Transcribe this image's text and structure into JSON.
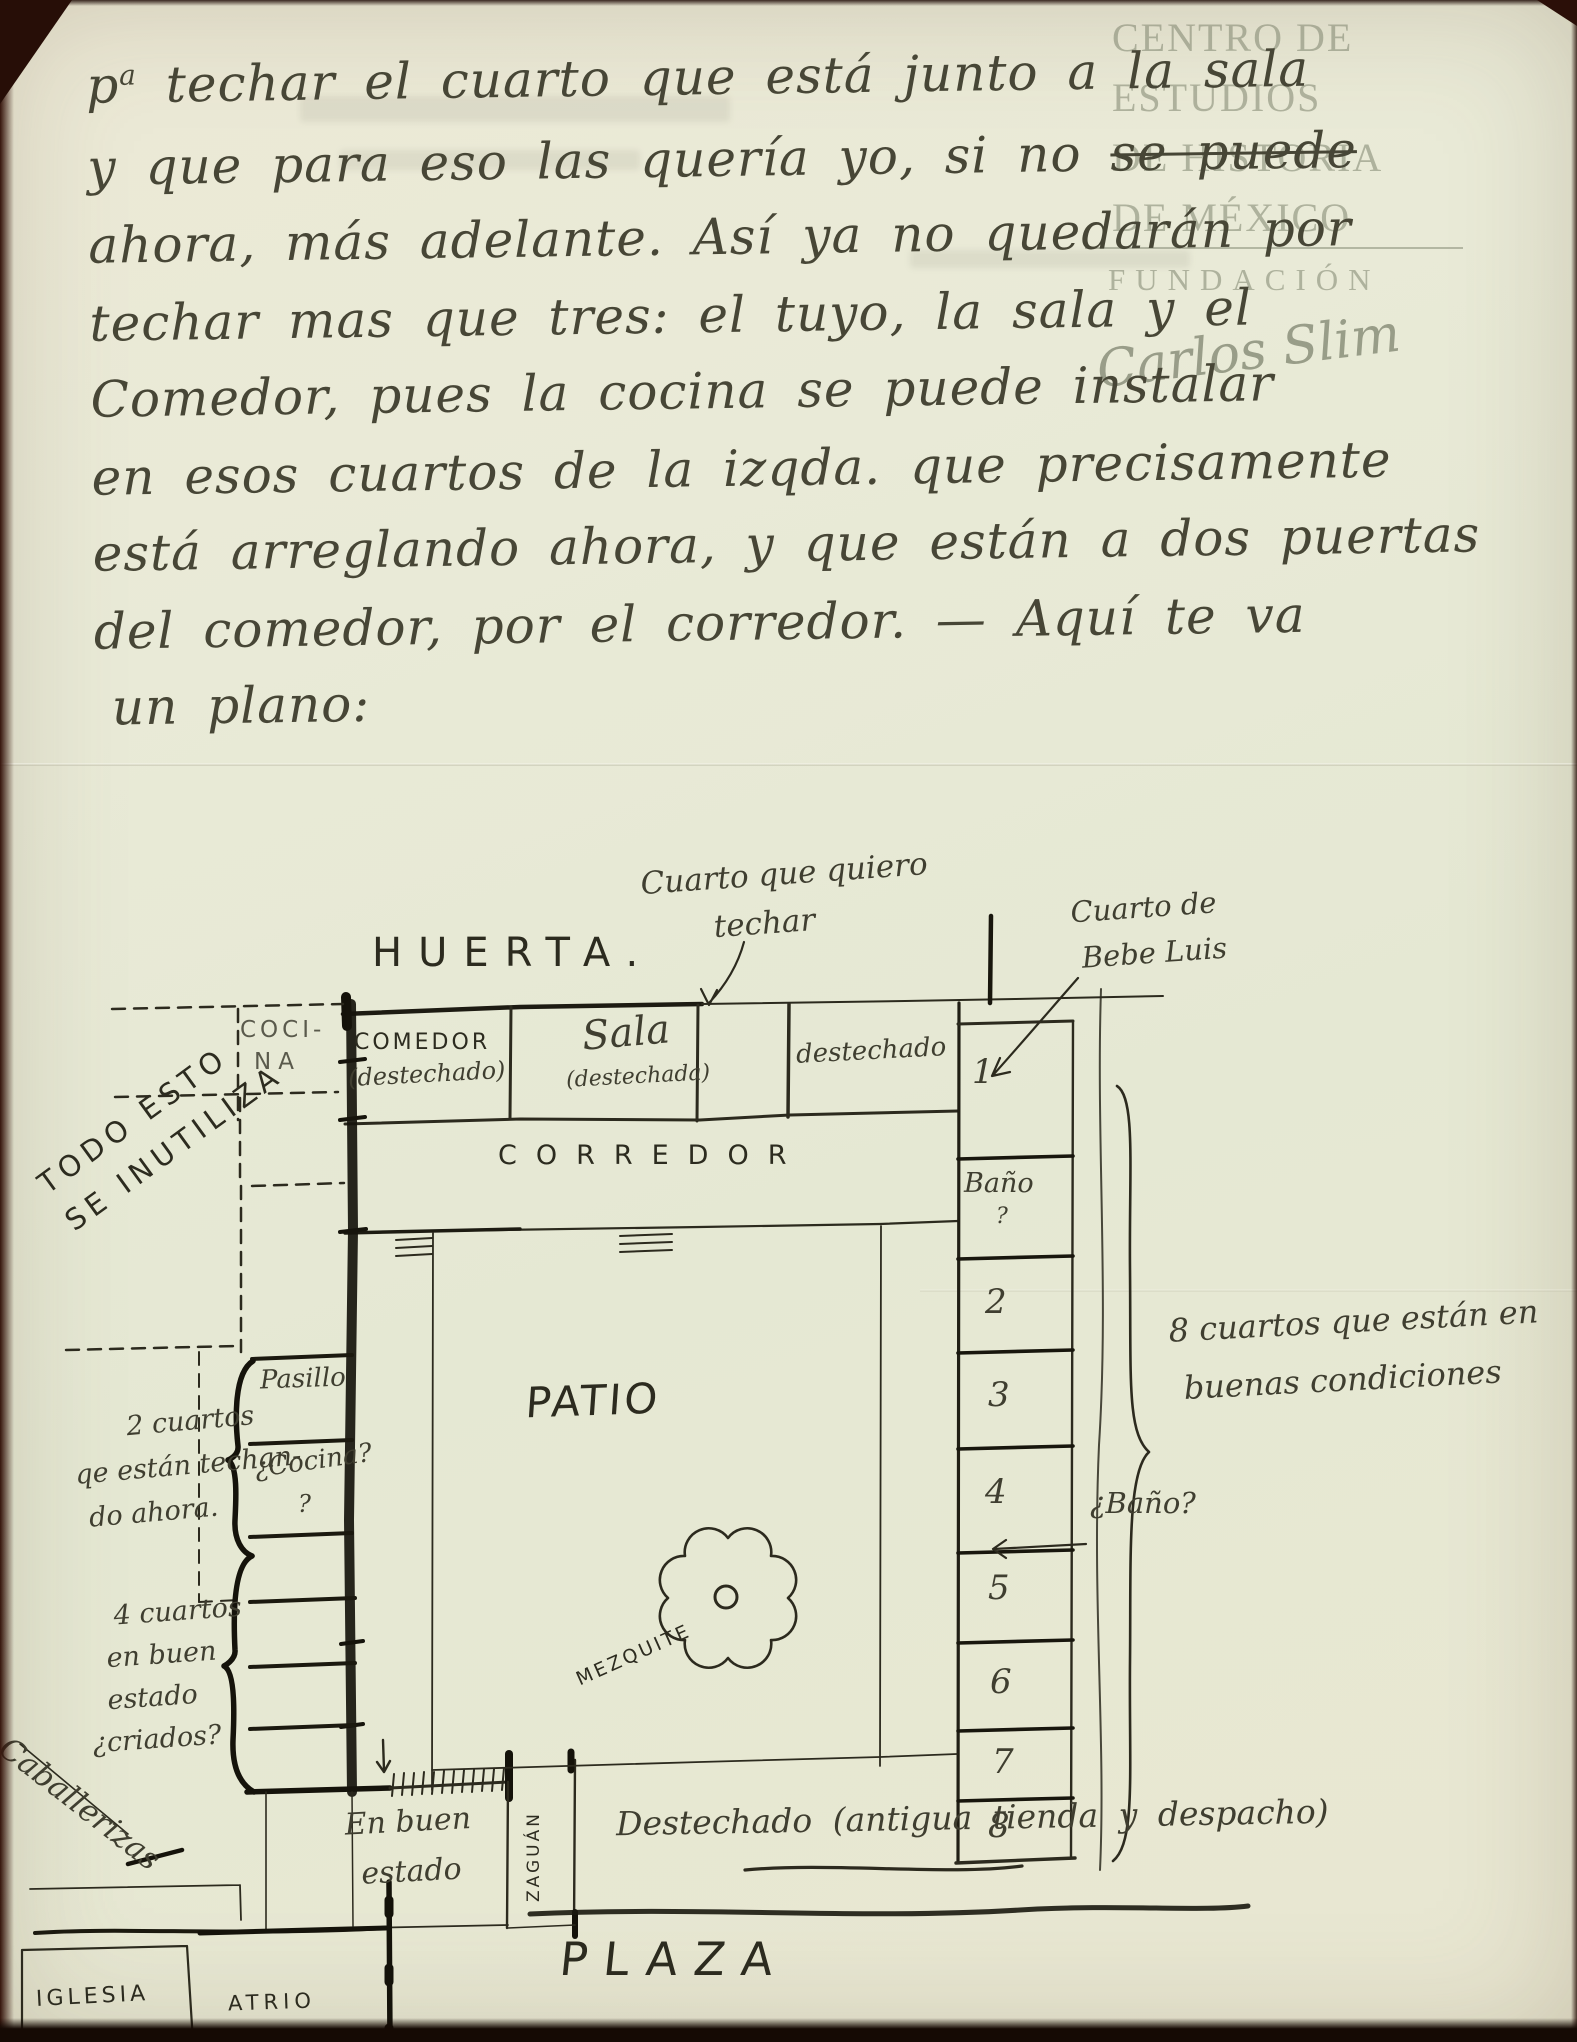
{
  "watermark": {
    "line1": "CENTRO DE",
    "line2": "ESTUDIOS",
    "line3": "DE HISTORIA",
    "line4": "DE MÉXICO",
    "foundation": "FUNDACIÓN",
    "signature": "Carlos Slim"
  },
  "letter": {
    "l1a": "p",
    "l1sup": "a",
    "l1b": " techar el cuarto que está junto a la sala",
    "l2a": "y que para eso las quería yo, si no ",
    "l2strike": "se puede",
    "l3": "ahora, más adelante. Así ya no quedarán por",
    "l4": "techar mas que tres: el tuyo, la sala y el",
    "l5": "Comedor, pues la cocina se puede instalar",
    "l6": "en esos cuartos de la izqda. que precisamente",
    "l7": "está arreglando ahora, y que están a dos puertas",
    "l8": "del comedor, por el corredor. — Aquí te va",
    "l9": "un plano:"
  },
  "plan": {
    "cuarto_techar_1": "Cuarto que quiero",
    "cuarto_techar_2": "techar",
    "bebe_luis_1": "Cuarto de",
    "bebe_luis_2": "Bebe Luis",
    "huerta": "HUERTA.",
    "cocina_dashed_1": "COCI-",
    "cocina_dashed_2": "NA",
    "comedor": "COMEDOR",
    "comedor_sub": "(destechado)",
    "sala": "Sala",
    "sala_sub": "(destechada)",
    "destechado_top": "destechado",
    "corredor": "CORREDOR",
    "todo_esto_1": "TODO ESTO",
    "todo_esto_2": "SE INUTILIZA",
    "bano_room": "Baño",
    "bano_room_q": "?",
    "rooms": [
      "1",
      "2",
      "3",
      "4",
      "5",
      "6",
      "7",
      "8"
    ],
    "ocho_cuartos_1": "8 cuartos que están en",
    "ocho_cuartos_2": "buenas condiciones",
    "bano_arrow": "¿Baño?",
    "pasillo": "Pasillo",
    "cocina_q": "¿Cocina?",
    "cocina_q2": "?",
    "dos_cuartos_1": "2 cuartos",
    "dos_cuartos_2": "qe están techan-",
    "dos_cuartos_3": "do ahora.",
    "patio": "PATIO",
    "mezquite": "MEZQUITE",
    "cuatro_cuartos_1": "4 cuartos",
    "cuatro_cuartos_2": "en buen",
    "cuatro_cuartos_3": "estado",
    "cuatro_cuartos_4": "¿criados?",
    "caballerizas": "Caballerizas",
    "en_buen_1": "En buen",
    "en_buen_2": "estado",
    "zaguan": "ZAGUÁN",
    "destechado_bottom": "Destechado (antigua tienda y despacho)",
    "plaza": "PLAZA",
    "iglesia": "IGLESIA",
    "atrio": "ATRIO"
  }
}
